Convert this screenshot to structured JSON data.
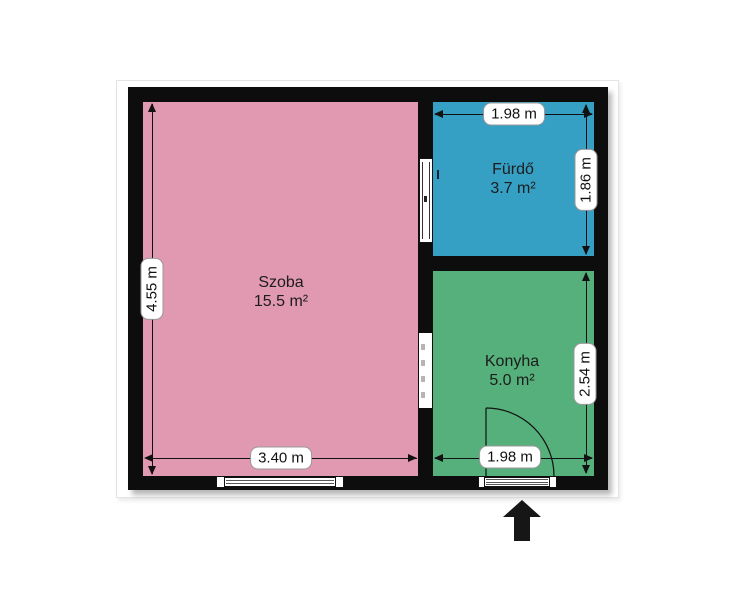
{
  "floorplan": {
    "rooms": [
      {
        "name": "Szoba",
        "area": "15.5 m²",
        "color": "#e198b1"
      },
      {
        "name": "Fürdő",
        "area": "3.7 m²",
        "color": "#359fc4"
      },
      {
        "name": "Konyha",
        "area": "5.0 m²",
        "color": "#55b07b"
      }
    ],
    "dimensions": {
      "szoba_height": "4.55 m",
      "szoba_width": "3.40 m",
      "furdo_width": "1.98 m",
      "furdo_height": "1.86 m",
      "konyha_height": "2.54 m",
      "konyha_width": "1.98 m"
    },
    "colors": {
      "wall": "#0d0d0d",
      "szoba_fill": "#e198b1",
      "furdo_fill": "#359fc4",
      "konyha_fill": "#55b07b",
      "dimension_line": "#111111",
      "label_background": "#ffffff",
      "entrance_arrow": "#161616"
    },
    "icons": {
      "entrance_arrow": "up-arrow",
      "door_swing": "quarter-arc"
    }
  }
}
